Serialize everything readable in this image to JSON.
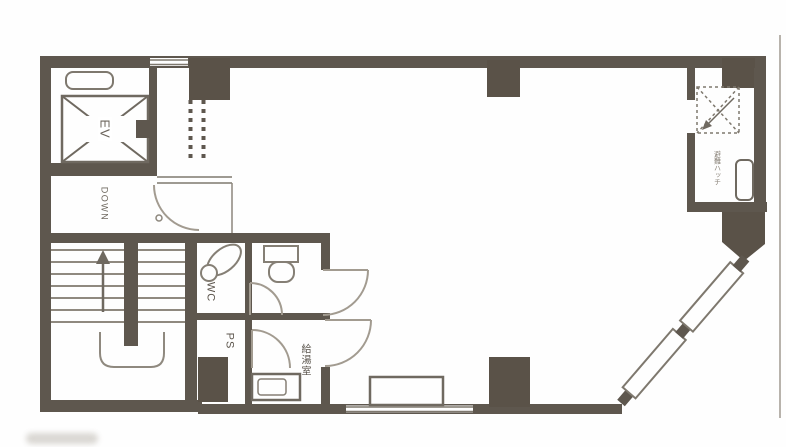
{
  "plan": {
    "labels": {
      "elevator": "EV",
      "stairs_direction": "DOWN",
      "toilet": "WC",
      "pipe_shaft": "PS",
      "kitchenette": "給湯室",
      "hatch": "避難ハッチ"
    },
    "colors": {
      "wall": "#5e574e",
      "pillar": "#5a5248",
      "thin_line": "#7e786e",
      "fixture_line": "#857f75",
      "door_arc": "#a29b90",
      "tread_line": "#8f897f",
      "boundary_line": "#b8b3ac",
      "background": "#fefefe"
    }
  }
}
